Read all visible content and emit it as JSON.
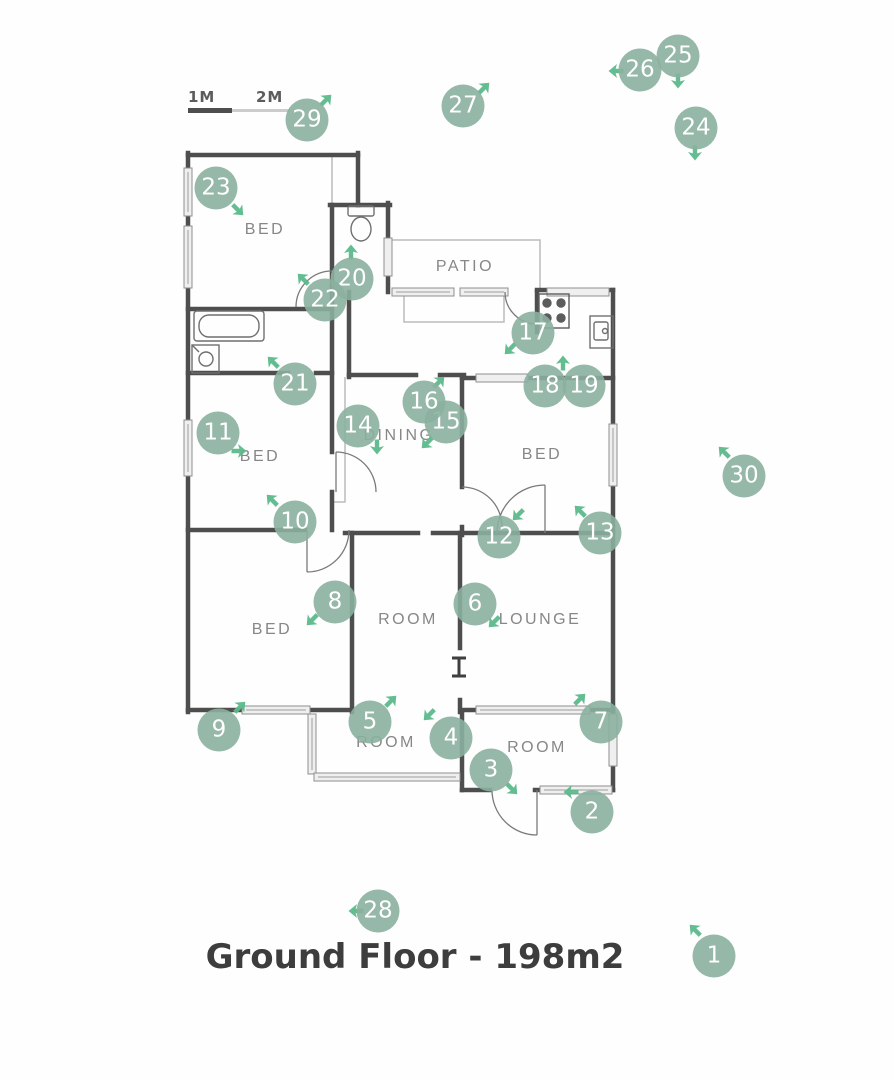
{
  "title": "Ground Floor - 198m2",
  "scale_bar": {
    "label_1m": "1M",
    "label_2m": "2M"
  },
  "colors": {
    "marker_circle": "rgba(139,176,158,0.9)",
    "direction_arrow": "#5cb98b",
    "wall": "#4e4e4e",
    "room_label": "#878787",
    "title": "#3d3d3d"
  },
  "rooms": [
    {
      "label": "BED",
      "x": 265,
      "y": 230
    },
    {
      "label": "PATIO",
      "x": 465,
      "y": 267
    },
    {
      "label": "BED",
      "x": 260,
      "y": 457
    },
    {
      "label": "DINING",
      "x": 399,
      "y": 436
    },
    {
      "label": "BED",
      "x": 542,
      "y": 455
    },
    {
      "label": "BED",
      "x": 272,
      "y": 630
    },
    {
      "label": "ROOM",
      "x": 408,
      "y": 620
    },
    {
      "label": "LOUNGE",
      "x": 540,
      "y": 620
    },
    {
      "label": "ROOM",
      "x": 386,
      "y": 743
    },
    {
      "label": "ROOM",
      "x": 537,
      "y": 748
    }
  ],
  "markers": [
    {
      "n": "1",
      "x": 714,
      "y": 956,
      "arrow": {
        "x": 695,
        "y": 930,
        "rot": -45
      }
    },
    {
      "n": "2",
      "x": 592,
      "y": 812,
      "arrow": {
        "x": 571,
        "y": 792,
        "rot": -90
      }
    },
    {
      "n": "3",
      "x": 491,
      "y": 770,
      "arrow": {
        "x": 512,
        "y": 789,
        "rot": 135
      }
    },
    {
      "n": "4",
      "x": 451,
      "y": 738,
      "arrow": {
        "x": 429,
        "y": 715,
        "rot": 225
      }
    },
    {
      "n": "5",
      "x": 370,
      "y": 722,
      "arrow": {
        "x": 391,
        "y": 701,
        "rot": 45
      }
    },
    {
      "n": "6",
      "x": 475,
      "y": 604,
      "arrow": {
        "x": 494,
        "y": 622,
        "rot": 225
      }
    },
    {
      "n": "7",
      "x": 601,
      "y": 722,
      "arrow": {
        "x": 580,
        "y": 699,
        "rot": 45
      }
    },
    {
      "n": "8",
      "x": 335,
      "y": 602,
      "arrow": {
        "x": 312,
        "y": 620,
        "rot": 225
      }
    },
    {
      "n": "9",
      "x": 219,
      "y": 730,
      "arrow": {
        "x": 240,
        "y": 707,
        "rot": 45
      }
    },
    {
      "n": "10",
      "x": 295,
      "y": 522,
      "arrow": {
        "x": 272,
        "y": 500,
        "rot": -45
      }
    },
    {
      "n": "11",
      "x": 218,
      "y": 433,
      "arrow": {
        "x": 239,
        "y": 451,
        "rot": 90
      }
    },
    {
      "n": "12",
      "x": 499,
      "y": 537,
      "arrow": {
        "x": 518,
        "y": 515,
        "rot": 225
      }
    },
    {
      "n": "13",
      "x": 600,
      "y": 533,
      "arrow": {
        "x": 580,
        "y": 511,
        "rot": -45
      }
    },
    {
      "n": "14",
      "x": 358,
      "y": 426,
      "arrow": {
        "x": 377,
        "y": 447,
        "rot": 180
      }
    },
    {
      "n": "15",
      "x": 446,
      "y": 422,
      "arrow": {
        "x": 427,
        "y": 443,
        "rot": 225
      }
    },
    {
      "n": "16",
      "x": 424,
      "y": 402,
      "arrow": {
        "x": 439,
        "y": 382,
        "rot": 45
      }
    },
    {
      "n": "17",
      "x": 533,
      "y": 333,
      "arrow": {
        "x": 510,
        "y": 349,
        "rot": 225
      }
    },
    {
      "n": "18",
      "x": 545,
      "y": 386,
      "arrow": {
        "x": 563,
        "y": 363,
        "rot": 0
      }
    },
    {
      "n": "19",
      "x": 584,
      "y": 386,
      "arrow": null
    },
    {
      "n": "20",
      "x": 352,
      "y": 279,
      "arrow": {
        "x": 351,
        "y": 252,
        "rot": 0
      }
    },
    {
      "n": "21",
      "x": 295,
      "y": 384,
      "arrow": {
        "x": 273,
        "y": 362,
        "rot": -45
      }
    },
    {
      "n": "22",
      "x": 325,
      "y": 300,
      "arrow": {
        "x": 303,
        "y": 279,
        "rot": -45
      }
    },
    {
      "n": "23",
      "x": 216,
      "y": 188,
      "arrow": {
        "x": 238,
        "y": 210,
        "rot": 135
      }
    },
    {
      "n": "24",
      "x": 696,
      "y": 128,
      "arrow": {
        "x": 695,
        "y": 153,
        "rot": 180
      }
    },
    {
      "n": "25",
      "x": 678,
      "y": 56,
      "arrow": {
        "x": 678,
        "y": 81,
        "rot": 180
      }
    },
    {
      "n": "26",
      "x": 640,
      "y": 70,
      "arrow": {
        "x": 616,
        "y": 71,
        "rot": -90
      }
    },
    {
      "n": "27",
      "x": 463,
      "y": 106,
      "arrow": {
        "x": 484,
        "y": 88,
        "rot": 45
      }
    },
    {
      "n": "28",
      "x": 378,
      "y": 911,
      "arrow": {
        "x": 356,
        "y": 911,
        "rot": -90
      }
    },
    {
      "n": "29",
      "x": 307,
      "y": 120,
      "arrow": {
        "x": 326,
        "y": 100,
        "rot": 45
      }
    },
    {
      "n": "30",
      "x": 744,
      "y": 476,
      "arrow": {
        "x": 724,
        "y": 452,
        "rot": -45
      }
    }
  ]
}
